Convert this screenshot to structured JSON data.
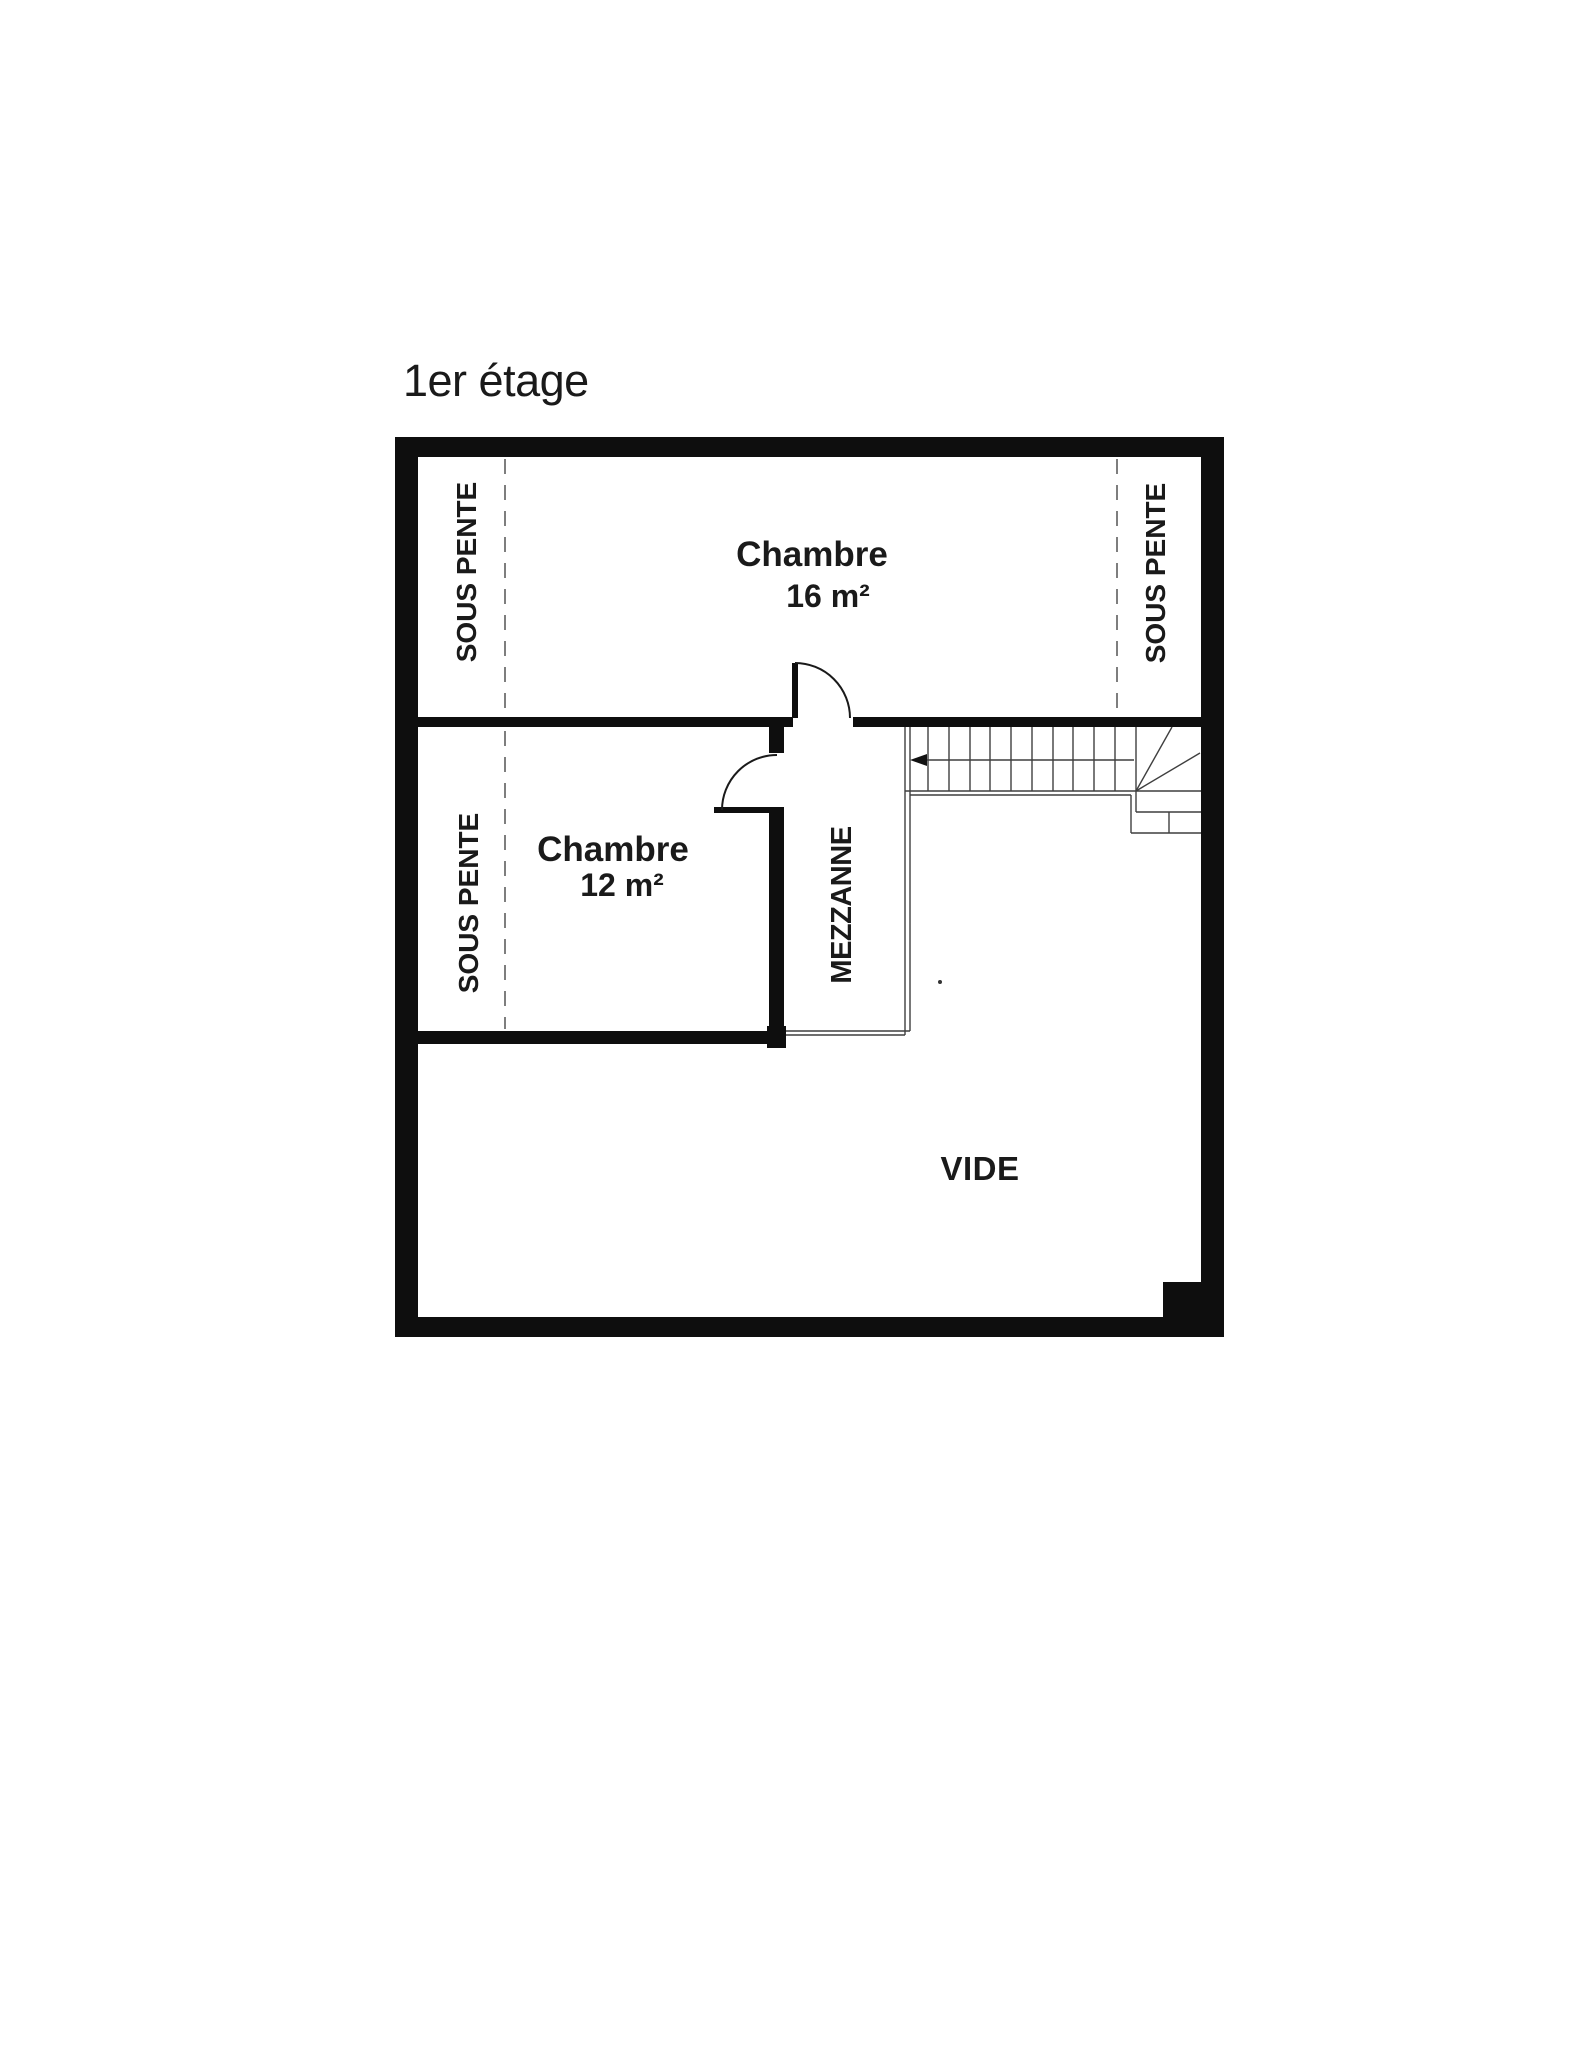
{
  "title": "1er étage",
  "rooms": {
    "chambre16": {
      "name": "Chambre",
      "area": "16 m²"
    },
    "chambre12": {
      "name": "Chambre",
      "area": "12 m²"
    }
  },
  "labels": {
    "mezzanine": "MEZZANNE",
    "vide": "VIDE",
    "sous_pente_left_top": "SOUS PENTE",
    "sous_pente_left_bottom": "SOUS PENTE",
    "sous_pente_right": "SOUS PENTE"
  },
  "colors": {
    "wall": "#0e0e0e",
    "thin_line": "#3f3f3f",
    "dashed_line": "#7e7e7e",
    "text": "#1a1a1a",
    "background": "#ffffff"
  }
}
